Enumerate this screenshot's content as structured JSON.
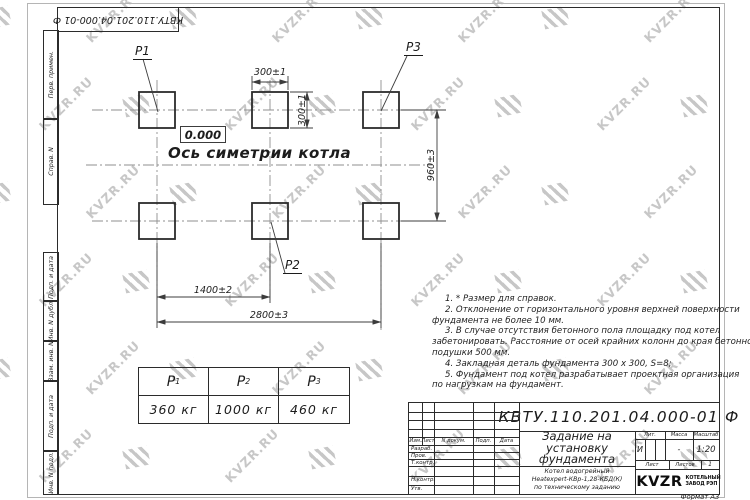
{
  "watermark": {
    "text": "KVZR.RU"
  },
  "top_stamp": {
    "doc_number": "КВТУ.110.201.04.000-01  Ф"
  },
  "sidebar": {
    "labels": [
      "Перв. примен.",
      "Справ. N",
      "Подп. и дата",
      "Инв. N дубл.",
      "Взам. инв. N",
      "Подп. и дата",
      "Инв. N подл."
    ]
  },
  "drawing": {
    "elevation": "0.000",
    "axis_label": "Ось симетрии котла",
    "pad_labels": {
      "p1": "P1",
      "p2": "P2",
      "p3": "P3"
    },
    "dims": {
      "pad_width": "300±1",
      "pad_height": "300±1",
      "row_spacing": "960±3",
      "col_spacing_mid": "1400±2",
      "col_spacing_total": "2800±3"
    }
  },
  "notes": {
    "lines": [
      {
        "indent": true,
        "text": "1. * Размер для справок."
      },
      {
        "indent": true,
        "text": "2. Отклонение от горизонтального уровня верхней поверхности"
      },
      {
        "indent": false,
        "text": "фундамента не более 10 мм."
      },
      {
        "indent": true,
        "text": "3. В случае отсутствия бетонного пола площадку под котел"
      },
      {
        "indent": false,
        "text": "забетонировать. Расстояние от осей крайних колонн до края бетонной"
      },
      {
        "indent": false,
        "text": "подушки 500 мм."
      },
      {
        "indent": true,
        "text": "4. Закладная деталь фундамента  300 x 300, S=8;"
      },
      {
        "indent": true,
        "text": "5. Фундамент под котел разрабатывает проектная организация"
      },
      {
        "indent": false,
        "text": "по нагрузкам на фундамент."
      }
    ]
  },
  "load_table": {
    "columns": [
      {
        "label": "P",
        "sub": "1",
        "value": "360 кг"
      },
      {
        "label": "P",
        "sub": "2",
        "value": "1000 кг"
      },
      {
        "label": "P",
        "sub": "3",
        "value": "460 кг"
      }
    ]
  },
  "title_block": {
    "doc_number": "КВТУ.110.201.04.000-01 Ф",
    "title_lines": [
      "Задание на",
      "установку",
      "фундамента"
    ],
    "subject_lines": [
      "Котел водогрейный",
      "Heatexpert-КВр-1,28-КБД(К)",
      "по техническому заданию"
    ],
    "columns": {
      "izm": "Изм.",
      "list": "Лист",
      "doc": "N докум.",
      "sign": "Подп.",
      "date": "Дата"
    },
    "roles": [
      "Разраб.",
      "Пров.",
      "Т.контр.",
      "Н.контр.",
      "Утв."
    ],
    "lit_label": "Лит.",
    "lit_value": "И",
    "mass_label": "Масса",
    "mass_value": "-",
    "scale_label": "Масштаб",
    "scale_value": "1:20",
    "sheet_label": "Лист",
    "sheets_label": "Листов",
    "sheets_value": "1",
    "logo_text": "KVZR",
    "logo_caption": [
      "КОТЕЛЬНЫЙ",
      "ЗАВОД РЭП"
    ],
    "format_label": "Формат А3"
  }
}
